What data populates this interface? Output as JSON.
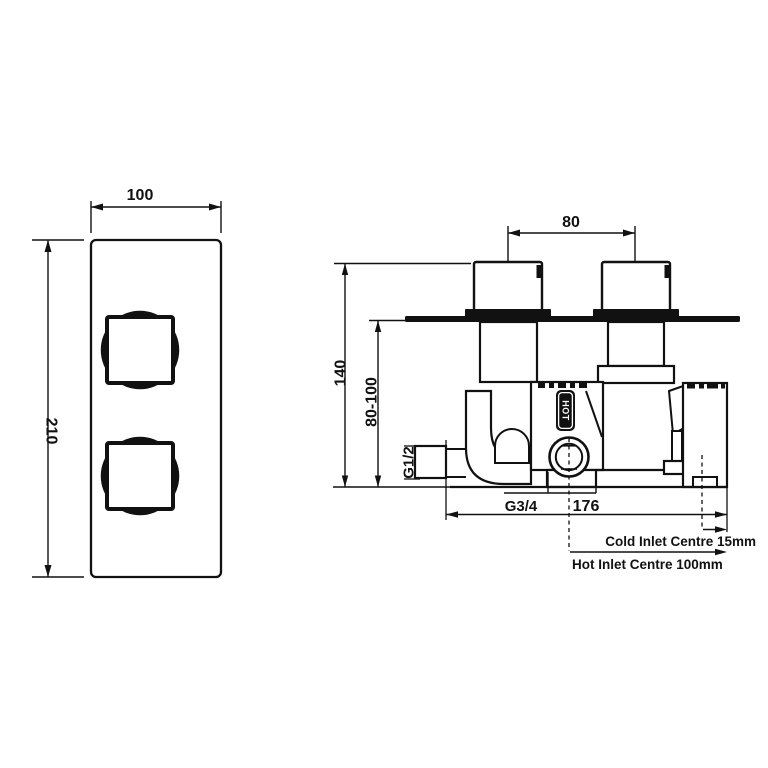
{
  "colors": {
    "line": "#111111",
    "background": "#ffffff"
  },
  "front_view": {
    "width_dim": "100",
    "height_dim": "210"
  },
  "side_view": {
    "handle_centres_dim": "80",
    "height_dim": "140",
    "wall_depth_dim": "80-100",
    "outlet_thread": "G1/2",
    "inlet_thread": "G3/4",
    "body_width_dim": "176",
    "hot_badge": "HOT",
    "cold_inlet_note": "Cold Inlet Centre 15mm",
    "hot_inlet_note": "Hot Inlet Centre 100mm"
  }
}
